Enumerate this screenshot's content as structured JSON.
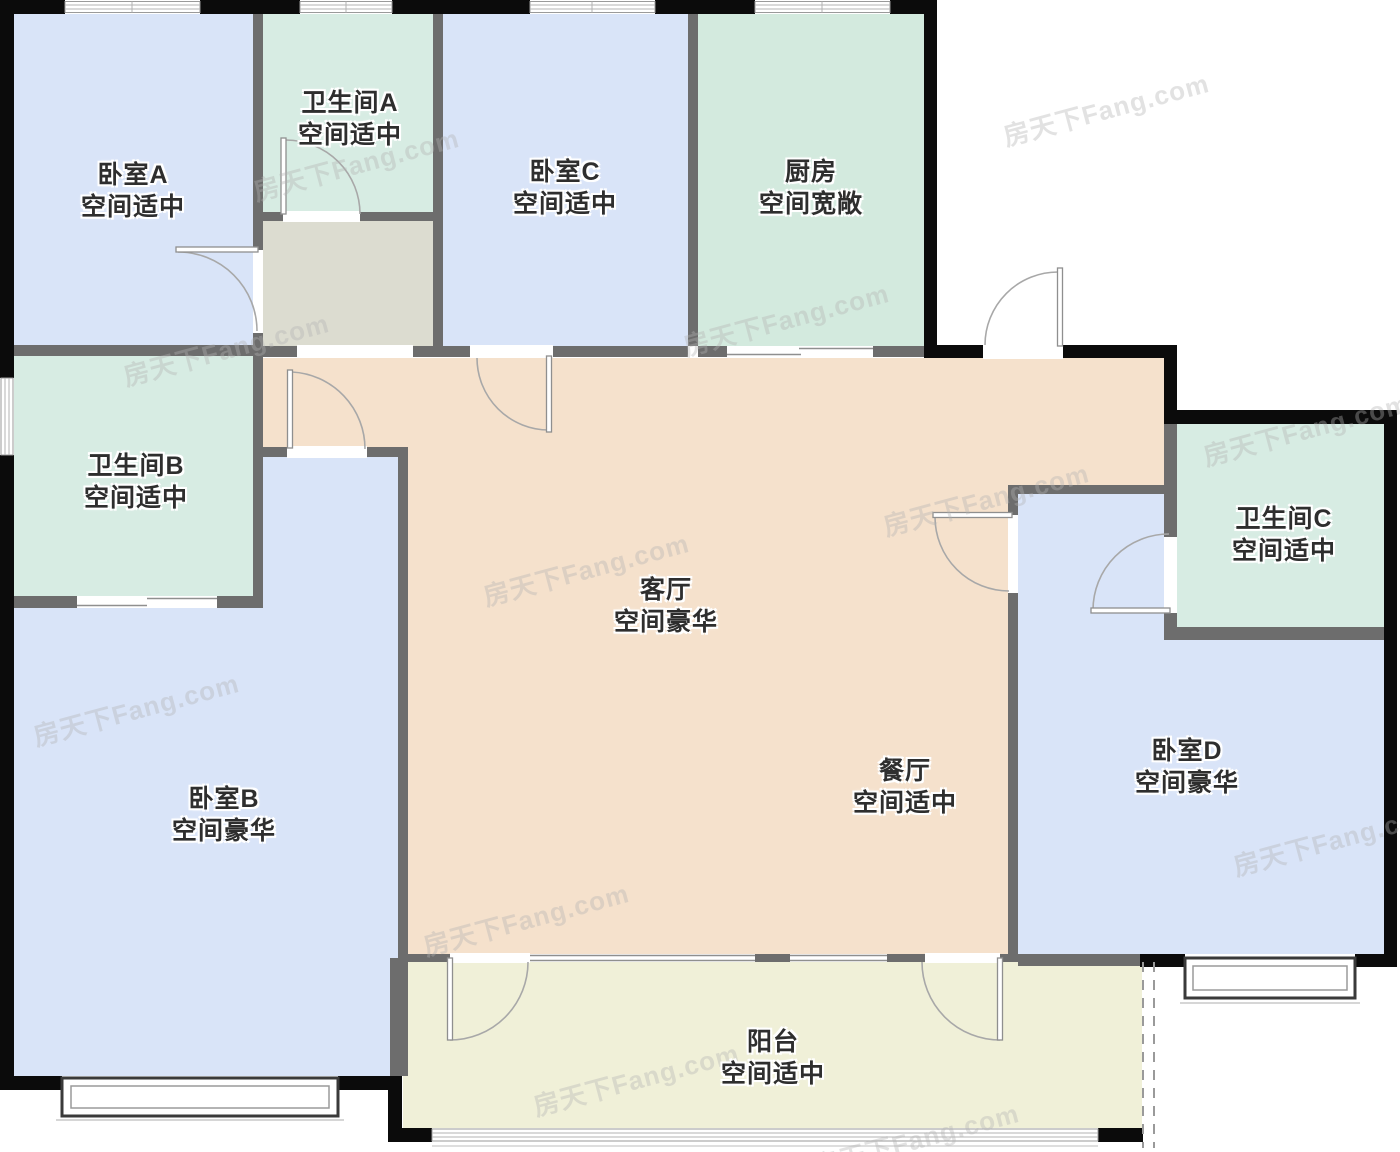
{
  "watermark": "房天下Fang.com",
  "rooms": [
    {
      "id": "bedroom-a",
      "name": "卧室A",
      "desc": "空间适中"
    },
    {
      "id": "bathroom-a",
      "name": "卫生间A",
      "desc": "空间适中"
    },
    {
      "id": "bedroom-c",
      "name": "卧室C",
      "desc": "空间适中"
    },
    {
      "id": "kitchen",
      "name": "厨房",
      "desc": "空间宽敞"
    },
    {
      "id": "bathroom-b",
      "name": "卫生间B",
      "desc": "空间适中"
    },
    {
      "id": "living-room",
      "name": "客厅",
      "desc": "空间豪华"
    },
    {
      "id": "bathroom-c",
      "name": "卫生间C",
      "desc": "空间适中"
    },
    {
      "id": "bedroom-b",
      "name": "卧室B",
      "desc": "空间豪华"
    },
    {
      "id": "dining-room",
      "name": "餐厅",
      "desc": "空间适中"
    },
    {
      "id": "bedroom-d",
      "name": "卧室D",
      "desc": "空间豪华"
    },
    {
      "id": "balcony",
      "name": "阳台",
      "desc": "空间适中"
    }
  ],
  "colors": {
    "bedroom_fill": "#d9e4f8",
    "bath_kitchen_fill": "#d7ece3",
    "living_dining_fill": "#f5e1cc",
    "balcony_fill": "#f0f0d8",
    "foyer_fill": "#dcdcd0",
    "exterior_wall": "#0b0b0b",
    "interior_wall": "#6d6d6d"
  }
}
